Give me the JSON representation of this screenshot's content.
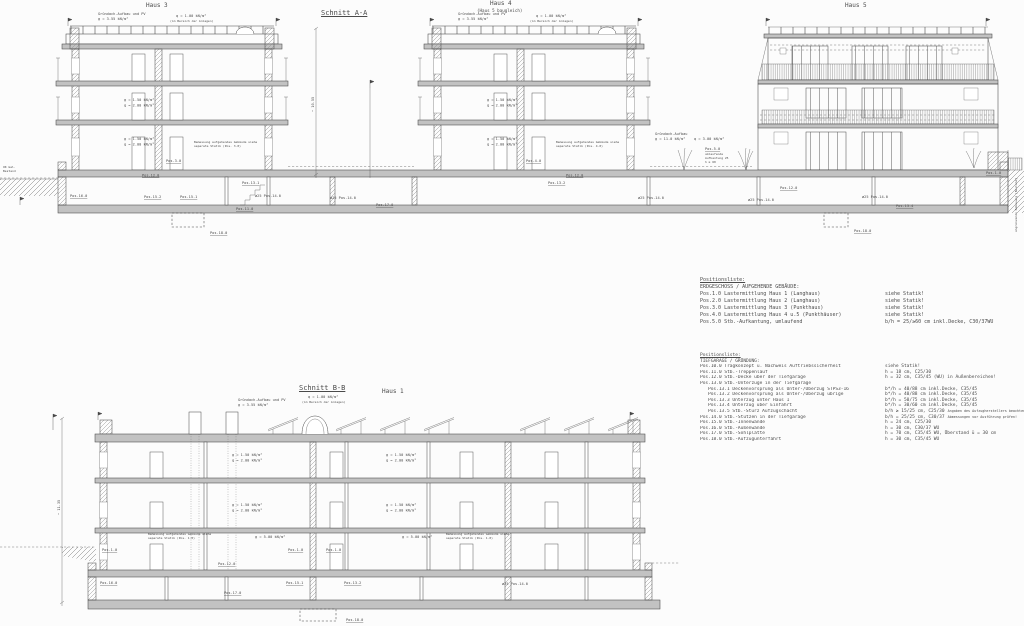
{
  "sheet": {
    "bg": "#fcfcfc",
    "line_color": "#474747",
    "slab_color": "#c2c2c2"
  },
  "sections": {
    "aa": {
      "title": "Schnitt A-A",
      "haus3_label": "Haus 3",
      "haus4_label": "Haus 4",
      "haus4_sub": "(Haus 5 baugleich)",
      "haus5_label": "Haus 5"
    },
    "bb": {
      "title": "Schnitt B-B",
      "haus1_label": "Haus 1"
    }
  },
  "poslist1": {
    "title": "Positionsliste:",
    "subtitle": "ERDGESCHOSS / AUFGEHENDE GEBÄUDE:",
    "rows": [
      {
        "pos": "Pos.1.0",
        "desc": "Lastermittlung Haus 1 (Langhaus)",
        "val": "siehe Statik!"
      },
      {
        "pos": "Pos.2.0",
        "desc": "Lastermittlung Haus 2 (Langhaus)",
        "val": "siehe Statik!"
      },
      {
        "pos": "Pos.3.0",
        "desc": "Lastermittlung Haus 3 (Punkthaus)",
        "val": "siehe Statik!"
      },
      {
        "pos": "Pos.4.0",
        "desc": "Lastermittlung Haus 4 u.5 (Punkthäuser)",
        "val": "siehe Statik!"
      },
      {
        "pos": "Pos.5.0",
        "desc": "Stb.-Aufkantung, umlaufend",
        "val": "b/h = 25/≥60 cm inkl.Decke, C30/37WU"
      }
    ]
  },
  "poslist2": {
    "title": "Positionsliste:",
    "subtitle": "TIEFGARAGE / GRÜNDUNG:",
    "rows": [
      {
        "pos": "Pos.10.0",
        "desc": "Tragkonzept u. Nachweis Auftriebssicherheit",
        "val": "siehe Statik!"
      },
      {
        "pos": "Pos.11.0",
        "desc": "Stb.-Treppenlauf",
        "val": "h = 18 cm, C25/30"
      },
      {
        "pos": "Pos.12.0",
        "desc": "Stb.-Decke über der Tiefgarage",
        "val": "h = 32 cm, C35/45 (WU) in Außenbereichen!"
      },
      {
        "pos": "Pos.13.0",
        "desc": "Stb.-Unterzüge in der Tiefgarage",
        "val": ""
      },
      {
        "pos": "Pos.13.1",
        "desc": "Deckenvorsprung als Unter-/Überzug STPS3-16",
        "val": "b*/h = 40/88 cm inkl.Decke, C35/45",
        "indent": true
      },
      {
        "pos": "Pos.13.2",
        "desc": "Deckenvorsprung als Unter-/Überzug übrige",
        "val": "b*/h = 40/88 cm inkl.Decke, C35/45",
        "indent": true
      },
      {
        "pos": "Pos.13.3",
        "desc": "Unterzug unter Haus 1",
        "val": "b*/h = 50/75 cm inkl.Decke, C35/45",
        "indent": true
      },
      {
        "pos": "Pos.13.4",
        "desc": "Unterzug über Einfahrt",
        "val": "b*/h = 30/60 cm inkl.Decke, C35/45",
        "indent": true
      },
      {
        "pos": "Pos.13.5",
        "desc": "Stb.-Sturz Aufzugschacht",
        "val": "b/h ≥ 15/25 cm, C25/30",
        "note": "Angaben des Aufzugherstellers beachten!",
        "indent": true
      },
      {
        "pos": "Pos.14.0",
        "desc": "Stb.-Stützen in der Tiefgarage",
        "val": "b/h = 25/25 cm, C30/37",
        "note": "Abmessungen vor Ausführung prüfen!"
      },
      {
        "pos": "Pos.15.0",
        "desc": "Stb.-Innenwände",
        "val": "h = 24 cm, C25/30"
      },
      {
        "pos": "Pos.16.0",
        "desc": "Stb.-Außenwände",
        "val": "h = 30 cm, C30/37 WU"
      },
      {
        "pos": "Pos.17.0",
        "desc": "Stb.-Sohlplatte",
        "val": "h = 70 cm, C35/45 WU, Überstand ü = 30 cm"
      },
      {
        "pos": "Pos.18.0",
        "desc": "Stb.-Aufzugunterfahrt",
        "val": "h = 30 cm, C35/45 WU"
      }
    ]
  },
  "annotations": [
    {
      "t": "Gründach-Aufbau und PV",
      "x": 98,
      "y": 15
    },
    {
      "t": "g = 3.55 kN/m²",
      "x": 98,
      "y": 20
    },
    {
      "t": "q = 1.00 kN/m²",
      "x": 176,
      "y": 17
    },
    {
      "t": "(im Bereich der Anlagen)",
      "x": 170,
      "y": 22,
      "fs": 3
    },
    {
      "t": "g = 1.50 kN/m²",
      "x": 124,
      "y": 101
    },
    {
      "t": "q = 2.00 kN/m²",
      "x": 124,
      "y": 106.5
    },
    {
      "t": "g = 1.50 kN/m²",
      "x": 124,
      "y": 140
    },
    {
      "t": "q = 2.00 kN/m²",
      "x": 124,
      "y": 145.5
    },
    {
      "t": "Bemessung aufgehendes Gebäude siehe",
      "x": 194,
      "y": 143,
      "fs": 3
    },
    {
      "t": "separate Statik (Pos. 3.0)",
      "x": 194,
      "y": 147,
      "fs": 3
    },
    {
      "t": "Pos.3.0",
      "x": 166,
      "y": 162,
      "u": 1
    },
    {
      "t": "Gründach-Aufbau und PV",
      "x": 458,
      "y": 15
    },
    {
      "t": "g = 3.55 kN/m²",
      "x": 458,
      "y": 20
    },
    {
      "t": "q = 1.00 kN/m²",
      "x": 536,
      "y": 17
    },
    {
      "t": "(im Bereich der Anlagen)",
      "x": 530,
      "y": 22,
      "fs": 3
    },
    {
      "t": "g = 1.50 kN/m²",
      "x": 487,
      "y": 101
    },
    {
      "t": "q = 2.00 kN/m²",
      "x": 487,
      "y": 106.5
    },
    {
      "t": "g = 1.50 kN/m²",
      "x": 487,
      "y": 140
    },
    {
      "t": "q = 2.00 kN/m²",
      "x": 487,
      "y": 145.5
    },
    {
      "t": "Bemessung aufgehendes Gebäude siehe",
      "x": 556,
      "y": 143,
      "fs": 3
    },
    {
      "t": "separate Statik (Pos. 4.0)",
      "x": 556,
      "y": 147,
      "fs": 3
    },
    {
      "t": "Pos.4.0",
      "x": 526,
      "y": 162,
      "u": 1
    },
    {
      "t": "Gründach-Aufbau",
      "x": 655,
      "y": 135
    },
    {
      "t": "g = 11.0 kN/m²",
      "x": 655,
      "y": 140
    },
    {
      "t": "q = 3.00 kN/m²",
      "x": 694,
      "y": 140
    },
    {
      "t": "Pos.5.0",
      "x": 705,
      "y": 150,
      "u": 1
    },
    {
      "t": "umlaufende",
      "x": 705,
      "y": 155,
      "fs": 3
    },
    {
      "t": "Aufkantung 25",
      "x": 705,
      "y": 159,
      "fs": 3
    },
    {
      "t": "h ≥ 60",
      "x": 705,
      "y": 163,
      "fs": 3
    },
    {
      "t": "OK Gel.",
      "x": 3,
      "y": 168,
      "fs": 3
    },
    {
      "t": "Bestand",
      "x": 3,
      "y": 172,
      "fs": 3
    },
    {
      "t": "~ 10.55",
      "x": 314,
      "y": 112,
      "r": -90
    },
    {
      "t": "angrenzende Bebauung (Bestand)",
      "x": 1017,
      "y": 232,
      "r": -90,
      "fs": 3
    },
    {
      "t": "Pos.16.0",
      "x": 70,
      "y": 197,
      "u": 1
    },
    {
      "t": "Pos.12.0",
      "x": 142,
      "y": 176.5,
      "u": 1
    },
    {
      "t": "Pos.15.2",
      "x": 144,
      "y": 198,
      "u": 1
    },
    {
      "t": "Pos.15.1",
      "x": 180,
      "y": 198,
      "u": 1
    },
    {
      "t": "Pos.13.1",
      "x": 242,
      "y": 184,
      "u": 1
    },
    {
      "t": "ø25 Pos.14.0",
      "x": 255,
      "y": 197
    },
    {
      "t": "Pos.11.0",
      "x": 236,
      "y": 210,
      "u": 1
    },
    {
      "t": "ø25 Pos.14.0",
      "x": 330,
      "y": 199
    },
    {
      "t": "Pos.13.2",
      "x": 548,
      "y": 184,
      "u": 1
    },
    {
      "t": "Pos.12.0",
      "x": 566,
      "y": 176.5,
      "u": 1
    },
    {
      "t": "ø25 Pos.14.0",
      "x": 638,
      "y": 199
    },
    {
      "t": "ø25 Pos.14.0",
      "x": 748,
      "y": 201
    },
    {
      "t": "Pos.12.0",
      "x": 780,
      "y": 189,
      "u": 1
    },
    {
      "t": "ø25 Pos.14.0",
      "x": 862,
      "y": 198
    },
    {
      "t": "Pos.13.4",
      "x": 896,
      "y": 207,
      "u": 1
    },
    {
      "t": "Pos.17.0",
      "x": 376,
      "y": 206,
      "u": 1
    },
    {
      "t": "Pos.18.0",
      "x": 210,
      "y": 234,
      "u": 1
    },
    {
      "t": "Pos.18.0",
      "x": 854,
      "y": 232,
      "u": 1
    },
    {
      "t": "Pos.1.0",
      "x": 986,
      "y": 174,
      "u": 1
    },
    {
      "t": "Gründach-Aufbau und PV",
      "x": 238,
      "y": 401
    },
    {
      "t": "g = 3.55 kN/m²",
      "x": 238,
      "y": 406
    },
    {
      "t": "q = 1.00 kN/m²",
      "x": 308,
      "y": 398
    },
    {
      "t": "(im Bereich der Anlagen)",
      "x": 302,
      "y": 403,
      "fs": 3
    },
    {
      "t": "g = 1.50 kN/m²",
      "x": 232,
      "y": 456
    },
    {
      "t": "q = 2.00 kN/m²",
      "x": 232,
      "y": 461.5
    },
    {
      "t": "g = 1.50 kN/m²",
      "x": 386,
      "y": 456
    },
    {
      "t": "q = 2.00 kN/m²",
      "x": 386,
      "y": 461.5
    },
    {
      "t": "g = 1.50 kN/m²",
      "x": 232,
      "y": 506
    },
    {
      "t": "q = 2.00 kN/m²",
      "x": 232,
      "y": 511.5
    },
    {
      "t": "g = 1.50 kN/m²",
      "x": 386,
      "y": 506
    },
    {
      "t": "q = 2.00 kN/m²",
      "x": 386,
      "y": 511.5
    },
    {
      "t": "Bemessung aufgehendes Gebäude siehe",
      "x": 148,
      "y": 535,
      "fs": 3
    },
    {
      "t": "separate Statik (Pos. 1.0)",
      "x": 148,
      "y": 539,
      "fs": 3
    },
    {
      "t": "g = 5.00 kN/m²",
      "x": 255,
      "y": 538
    },
    {
      "t": "g = 5.00 kN/m²",
      "x": 402,
      "y": 538
    },
    {
      "t": "Bemessung aufgehendes Gebäude siehe",
      "x": 446,
      "y": 535,
      "fs": 3
    },
    {
      "t": "separate Statik (Pos. 1.0)",
      "x": 446,
      "y": 539,
      "fs": 3
    },
    {
      "t": "Pos.1.0",
      "x": 102,
      "y": 551,
      "u": 1
    },
    {
      "t": "Pos.1.0",
      "x": 288,
      "y": 551,
      "u": 1
    },
    {
      "t": "Pos.1.0",
      "x": 326,
      "y": 551,
      "u": 1
    },
    {
      "t": "Pos.16.0",
      "x": 100,
      "y": 584,
      "u": 1
    },
    {
      "t": "Pos.12.0",
      "x": 218,
      "y": 565,
      "u": 1
    },
    {
      "t": "Pos.17.0",
      "x": 224,
      "y": 594,
      "u": 1
    },
    {
      "t": "Pos.15.1",
      "x": 286,
      "y": 584,
      "u": 1
    },
    {
      "t": "Pos.13.2",
      "x": 344,
      "y": 584,
      "u": 1
    },
    {
      "t": "ø25 Pos.14.0",
      "x": 502,
      "y": 585
    },
    {
      "t": "Pos.18.0",
      "x": 346,
      "y": 621,
      "u": 1
    },
    {
      "t": "~ 11.35",
      "x": 60,
      "y": 515,
      "r": -90
    }
  ]
}
